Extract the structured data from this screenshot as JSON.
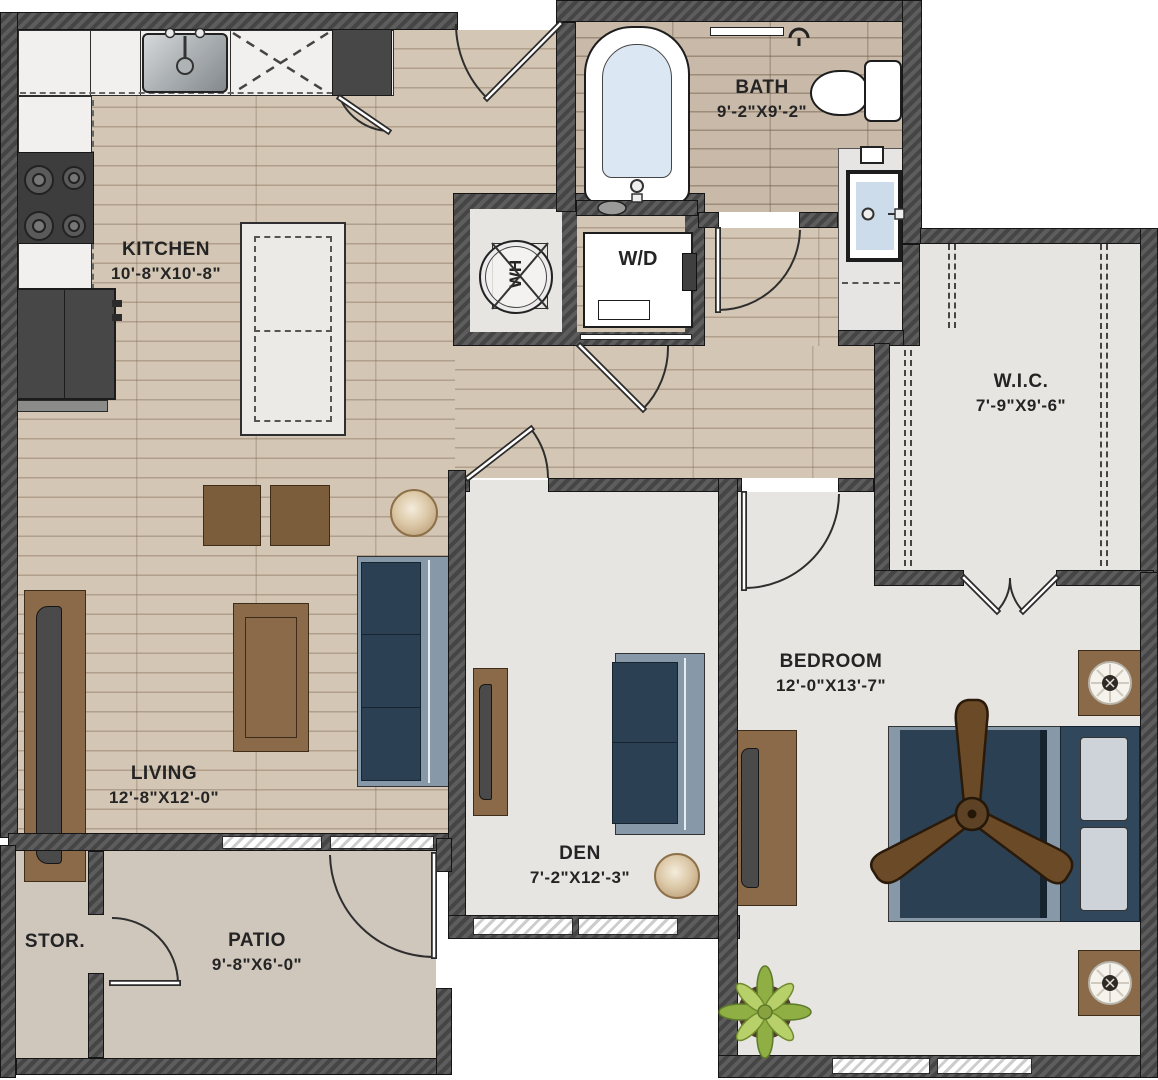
{
  "floorplan": {
    "rooms": {
      "kitchen": {
        "name": "KITCHEN",
        "dims": "10'-8\"X10'-8\""
      },
      "bath": {
        "name": "BATH",
        "dims": "9'-2\"X9'-2\""
      },
      "wic": {
        "name": "W.I.C.",
        "dims": "7'-9\"X9'-6\""
      },
      "bedroom": {
        "name": "BEDROOM",
        "dims": "12'-0\"X13'-7\""
      },
      "den": {
        "name": "DEN",
        "dims": "7'-2\"X12'-3\""
      },
      "living": {
        "name": "LIVING",
        "dims": "12'-8\"X12'-0\""
      },
      "patio": {
        "name": "PATIO",
        "dims": "9'-8\"X6'-0\""
      },
      "storage": {
        "name": "STOR."
      }
    },
    "fixtures": {
      "washer_dryer": "W/D",
      "water_heater": "WH"
    },
    "colors": {
      "wall": "#4d4d4d",
      "wood_floor": "#d4c6b4",
      "bath_floor": "#c8b9a9",
      "gray_floor": "#e6e5e2",
      "patio_floor": "#cfc6bc",
      "sofa_navy": "#2c4054",
      "furniture_brown": "#8a6a48",
      "sofa_frame": "#8798a8",
      "plant_green": "#a9c356"
    }
  }
}
